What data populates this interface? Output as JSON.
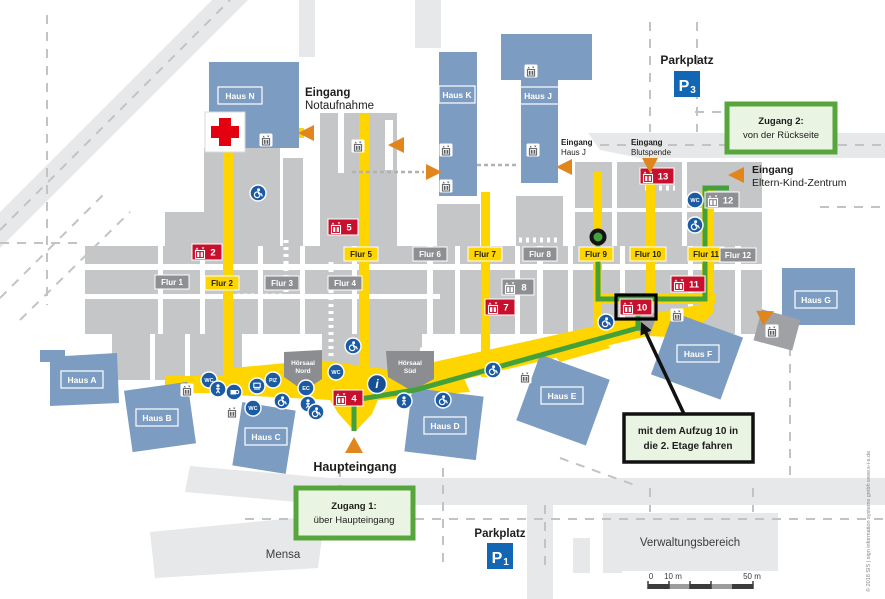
{
  "map": {
    "entrances": {
      "notaufnahme": {
        "line1": "Eingang",
        "line2": "Notaufnahme"
      },
      "haus_j": {
        "line1": "Eingang",
        "line2": "Haus J"
      },
      "blutspende": {
        "line1": "Eingang",
        "line2": "Blutspende"
      },
      "eltern_kind": {
        "line1": "Eingang",
        "line2": "Eltern-Kind-Zentrum"
      },
      "haupteingang": "Haupteingang"
    },
    "parking": {
      "p3": {
        "label": "Parkplatz",
        "p": "P",
        "sub": "3"
      },
      "p1": {
        "label": "Parkplatz",
        "p": "P",
        "sub": "1"
      }
    },
    "areas": {
      "mensa": "Mensa",
      "verwaltung": "Verwaltungsbereich"
    },
    "buildings": {
      "a": "Haus A",
      "b": "Haus B",
      "c": "Haus C",
      "d": "Haus D",
      "e": "Haus E",
      "f": "Haus F",
      "g": "Haus G",
      "j": "Haus J",
      "k": "Haus K",
      "n": "Haus N",
      "hoersaal_nord": {
        "line1": "Hörsaal",
        "line2": "Nord"
      },
      "hoersaal_sued": {
        "line1": "Hörsaal",
        "line2": "Süd"
      }
    },
    "corridors": {
      "f1": "Flur 1",
      "f2": "Flur 2",
      "f3": "Flur 3",
      "f4": "Flur 4",
      "f5": "Flur 5",
      "f6": "Flur 6",
      "f7": "Flur 7",
      "f8": "Flur 8",
      "f9": "Flur 9",
      "f10": "Flur 10",
      "f11": "Flur 11",
      "f12": "Flur 12"
    },
    "elevators": {
      "e2": "2",
      "e4": "4",
      "e5": "5",
      "e7": "7",
      "e8": "8",
      "e10": "10",
      "e11": "11",
      "e12": "12",
      "e13": "13"
    },
    "icons": {
      "wc": "WC",
      "piz": "PIZ",
      "info": "i",
      "ec": "EC"
    },
    "callouts": {
      "zugang1": {
        "line1": "Zugang 1:",
        "line2": "über Haupteingang"
      },
      "zugang2": {
        "line1": "Zugang 2:",
        "line2": "von der Rückseite"
      },
      "aufzug": {
        "line1": "mit dem Aufzug 10 in",
        "line2": "die 2. Etage fahren"
      }
    },
    "scale": {
      "t0": "0",
      "t10": "10 m",
      "t50": "50 m"
    },
    "credit": "© 2018   SIS | sign information systems gmbh    www.s-i-s.de",
    "colors": {
      "building_blue": "#7d9cc2",
      "path_yellow": "#ffd500",
      "route_green": "#43a13c",
      "elevator_red": "#c8102e",
      "label_gray": "#8d8f92",
      "entrance_orange": "#e0861c",
      "parking_blue": "#1266b4",
      "icon_blue": "#1a5ba4",
      "callout_fill": "#eaf4e3",
      "callout_green": "#57a63b"
    }
  }
}
